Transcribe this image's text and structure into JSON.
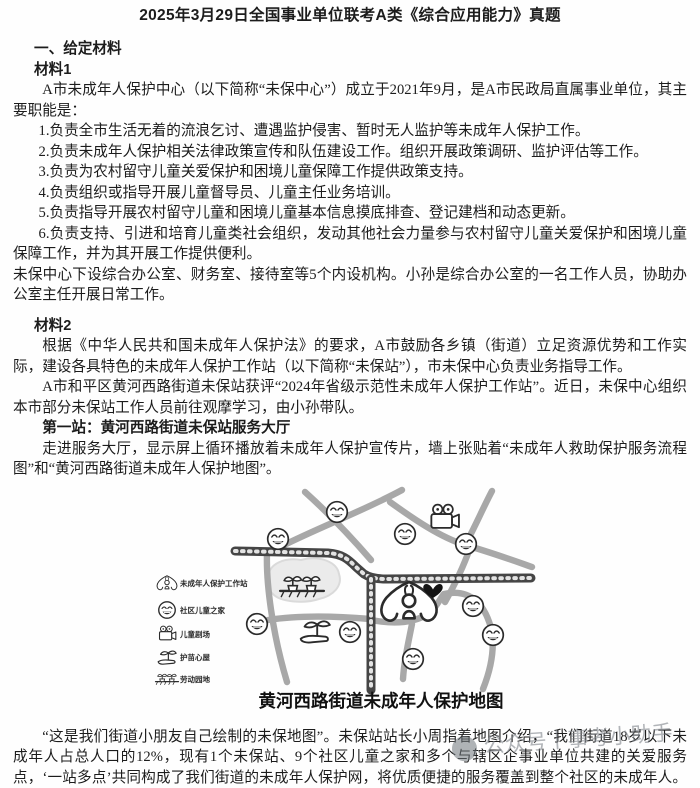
{
  "page": {
    "title": "2025年3月29日全国事业单位联考A类《综合应用能力》真题"
  },
  "content": {
    "section_heading": "一、给定材料",
    "material1_label": "材料1",
    "material1_intro": "A市未成年人保护中心（以下简称“未保中心”）成立于2021年9月，是A市民政局直属事业单位，其主要职能是：",
    "duties": [
      "1.负责全市生活无着的流浪乞讨、遭遇监护侵害、暂时无人监护等未成年人保护工作。",
      "2.负责未成年人保护相关法律政策宣传和队伍建设工作。组织开展政策调研、监护评估等工作。",
      "3.负责为农村留守儿童关爱保护和困境儿童保障工作提供政策支持。",
      "4.负责组织或指导开展儿童督导员、儿童主任业务培训。",
      "5.负责指导开展农村留守儿童和困境儿童基本信息摸底排查、登记建档和动态更新。",
      "6.负责支持、引进和培育儿童类社会组织，发动其他社会力量参与农村留守儿童关爱保护和困境儿童保障工作，并为其开展工作提供便利。"
    ],
    "material1_outro": "未保中心下设综合办公室、财务室、接待室等5个内设机构。小孙是综合办公室的一名工作人员，协助办公室主任开展日常工作。",
    "material2_label": "材料2",
    "material2_p1": "根据《中华人民共和国未成年人保护法》的要求，A市鼓励各乡镇（街道）立足资源优势和工作实际，建设各具特色的未成年人保护工作站（以下简称“未保站”），市未保中心负责业务指导工作。",
    "material2_p2": "A市和平区黄河西路街道未保站获评“2024年省级示范性未成年人保护工作站”。近日，未保中心组织本市部分未保站工作人员前往观摩学习，由小孙带队。",
    "stop1_heading": "第一站：黄河西路街道未保站服务大厅",
    "stop1_p1": "走进服务大厅，显示屏上循环播放着未成年人保护宣传片，墙上张贴着“未成年人救助保护服务流程图”和“黄河西路街道未成年人保护地图”。",
    "stop1_p2": "“这是我们街道小朋友自己绘制的未保地图”。未保站站长小周指着地图介绍，“我们街道18岁以下未成年人占总人口的12%，现有1个未保站、9个社区儿童之家和多个与辖区企事业单位共建的关爱服务点，‘一站多点’共同构成了我们街道的未成年人保护网，将优质便捷的服务覆盖到整个社区的未成年人。今"
  },
  "map": {
    "caption": "黄河西路街道未成年人保护地图",
    "legend": [
      {
        "icon": "hands-house-icon",
        "label": "未成年人保护工作站"
      },
      {
        "icon": "smiley-icon",
        "label": "社区儿童之家"
      },
      {
        "icon": "movie-camera-icon",
        "label": "儿童剧场"
      },
      {
        "icon": "hand-sprout-icon",
        "label": "护苗心屋"
      },
      {
        "icon": "sprout-bed-icon",
        "label": "劳动园地"
      }
    ],
    "markers": {
      "children_home_count": 9
    }
  },
  "watermark": {
    "text": "公众号丨事考小助手"
  },
  "colors": {
    "ink": "#2b2b2b",
    "road_dark": "#454545",
    "road_gray": "#a8a8a8",
    "pond_fill": "#ebebeb"
  }
}
